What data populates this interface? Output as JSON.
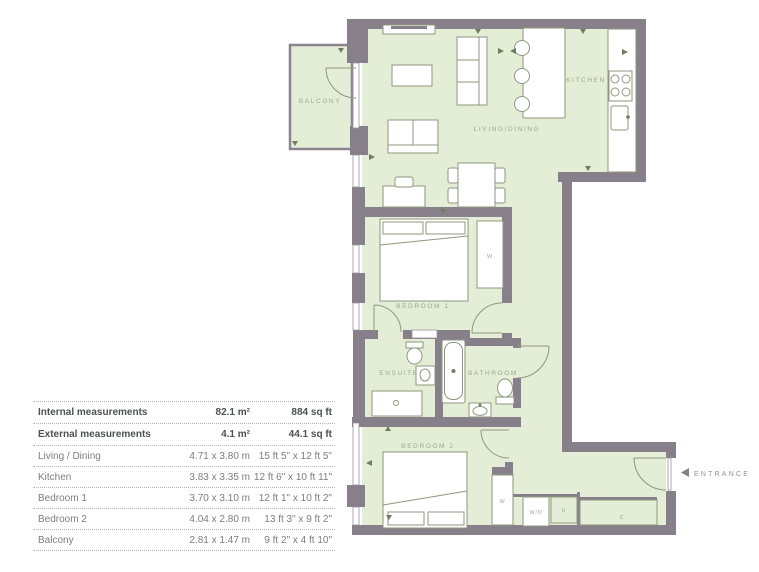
{
  "plan": {
    "rooms": {
      "balcony": "BALCONY",
      "living_dining": "LIVING/DINING",
      "kitchen": "KITCHEN",
      "bedroom1": "BEDROOM 1",
      "ensuite": "ENSUITE",
      "bathroom": "BATHROOM",
      "bedroom2": "BEDROOM 2"
    },
    "closets": {
      "wardrobe1": "W",
      "wardrobe2": "W",
      "washer_dryer": "W/D",
      "utility": "U",
      "cupboard": "C"
    },
    "entrance_label": "ENTRANCE"
  },
  "table": {
    "rows": [
      {
        "label": "Internal measurements",
        "metric": "82.1 m²",
        "imperial": "884 sq ft"
      },
      {
        "label": "External measurements",
        "metric": "4.1 m²",
        "imperial": "44.1 sq ft"
      },
      {
        "label": "Living / Dining",
        "metric": "4.71 x 3.80 m",
        "imperial": "15 ft 5\" x 12 ft 5\""
      },
      {
        "label": "Kitchen",
        "metric": "3.83 x 3.35 m",
        "imperial": "12 ft 6\" x 10 ft 11\""
      },
      {
        "label": "Bedroom 1",
        "metric": "3.70 x 3.10 m",
        "imperial": "12 ft 1\" x 10 ft 2\""
      },
      {
        "label": "Bedroom 2",
        "metric": "4.04 x 2.80 m",
        "imperial": "13 ft 3\" x 9 ft 2\""
      },
      {
        "label": "Balcony",
        "metric": "2.81 x 1.47 m",
        "imperial": "9 ft 2\" x 4 ft 10\""
      }
    ]
  },
  "colors": {
    "wall": "#87808a",
    "floor": "#e4eed7",
    "furniture_stroke": "#8f977e",
    "label_text": "#9fa68d",
    "table_bold_text": "#4f5052",
    "table_text": "#7c7d80"
  }
}
